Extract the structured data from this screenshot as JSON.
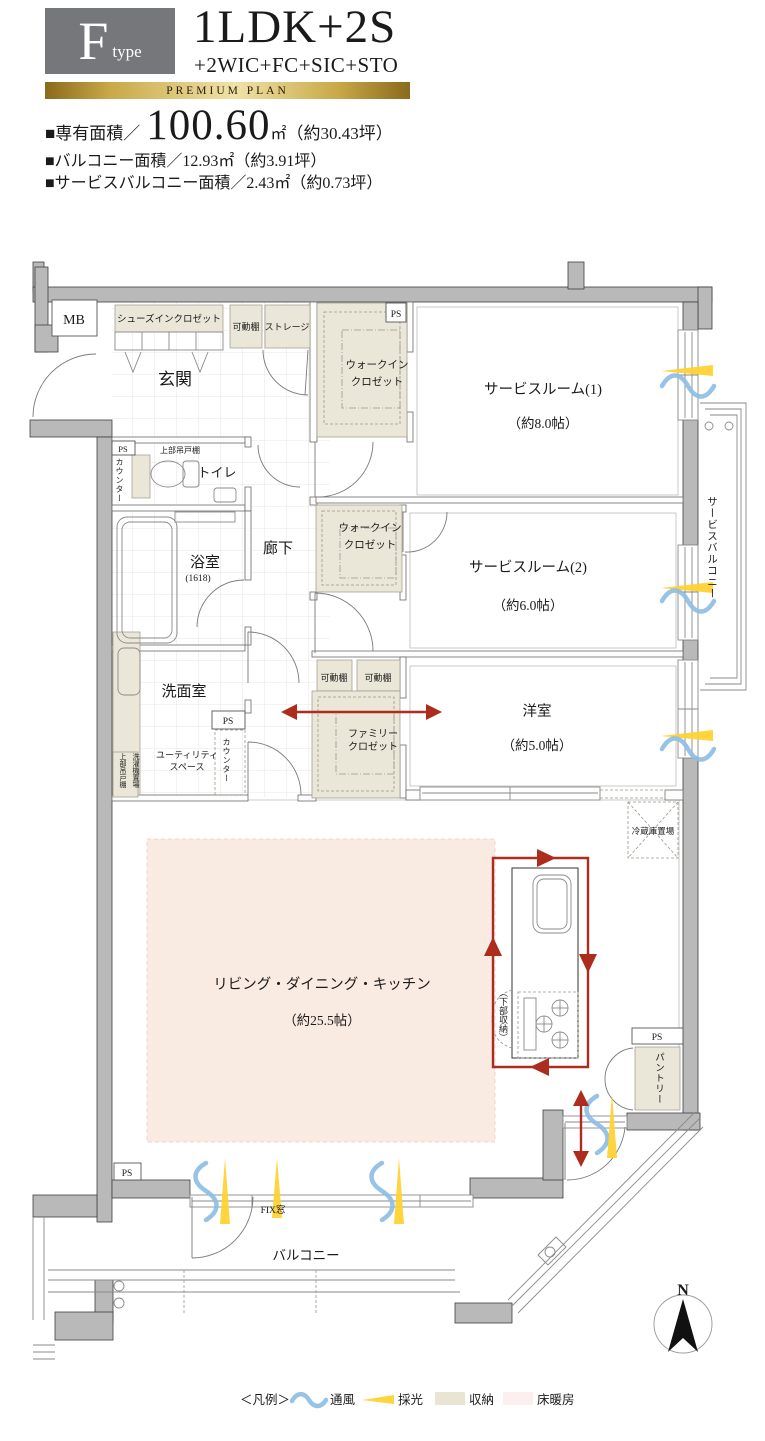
{
  "header": {
    "type_letter": "F",
    "type_word": "type",
    "plan_title": "1LDK+2S",
    "plan_subtitle": "+2WIC+FC+SIC+STO",
    "premium_label": "PREMIUM PLAN",
    "area_main_label": "■専有面積／",
    "area_main_value": "100.60",
    "area_main_unit": "㎡",
    "area_main_note": "（約30.43坪）",
    "area_balcony": "■バルコニー面積／12.93㎡（約3.91坪）",
    "area_service_balcony": "■サービスバルコニー面積／2.43㎡（約0.73坪）"
  },
  "rooms": {
    "entrance": "玄関",
    "shoes_in_closet": "シューズインクロゼット",
    "movable_shelf": "可動棚",
    "storage": "ストレージ",
    "wic_line1": "ウォークイン",
    "wic_line2": "クロゼット",
    "service_room_1": "サービスルーム(1)",
    "service_room_1_size": "（約8.0帖）",
    "service_room_2": "サービスルーム(2)",
    "service_room_2_size": "（約6.0帖）",
    "western_room": "洋室",
    "western_room_size": "（約5.0帖）",
    "toilet": "トイレ",
    "bath": "浴室",
    "bath_size": "(1618)",
    "washroom": "洗面室",
    "corridor": "廊下",
    "utility_line1": "ユーティリティ",
    "utility_line2": "スペース",
    "upper_cabinet": "上部吊戸棚",
    "washer_place": "洗濯機置場",
    "counter": "カウンター",
    "family_closet_line1": "ファミリー",
    "family_closet_line2": "クロゼット",
    "ldk": "リビング・ダイニング・キッチン",
    "ldk_size": "（約25.5帖）",
    "fridge_place": "冷蔵庫置場",
    "under_storage": "（下部収納）",
    "pantry": "パントリー",
    "balcony": "バルコニー",
    "service_balcony": "サービスバルコニー",
    "fix_window": "FIX窓",
    "ps": "PS",
    "mb": "MB",
    "north": "N"
  },
  "legend": {
    "title": "＜凡例＞",
    "ventilation": "通風",
    "daylight": "採光",
    "storage": "収納",
    "floor_heating": "床暖房"
  },
  "colors": {
    "wall": "#b9b9b9",
    "storage_fill": "#ebe7d8",
    "floor_heating_fill": "#f9eae2",
    "legend_floor_heating": "#fdeff0",
    "ventilation_blue": "#8cbce4",
    "daylight_yellow": "#ffd232",
    "flow_arrow_red": "#ac2c1e",
    "premium_gold": "#c9a948",
    "type_box_gray": "#76777a"
  }
}
